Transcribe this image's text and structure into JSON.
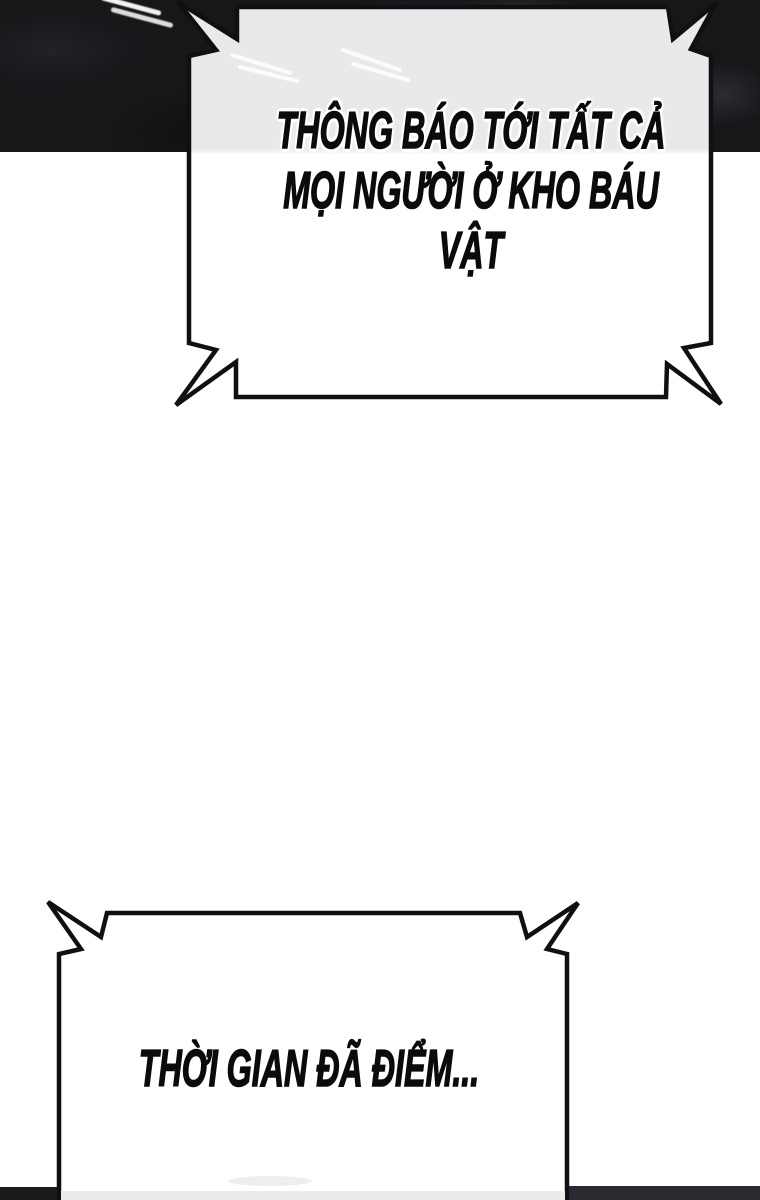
{
  "bubbles": {
    "top": {
      "shape": "announcement-burst-rectangle",
      "lines": [
        "THÔNG BÁO TỚI TẤT CẢ",
        "MỌI NGƯỜI Ở KHO BÁU",
        "VẬT"
      ]
    },
    "bottom": {
      "shape": "announcement-burst-rectangle",
      "lines": [
        "THỜI GIAN ĐÃ ĐIỂM..."
      ]
    }
  },
  "colors": {
    "ink_outline": "#101013",
    "text_color": "#0b0b0d",
    "text_halo": "#ffffff",
    "bubble_fill_over_dark": "#e9e9ec",
    "bubble_fill": "#ffffff",
    "ceiling_dark": "#17171a",
    "light_streak": "#f2f2f4",
    "bottom_left_band": "#1b1b1d",
    "bottom_right_band": "#282931"
  }
}
